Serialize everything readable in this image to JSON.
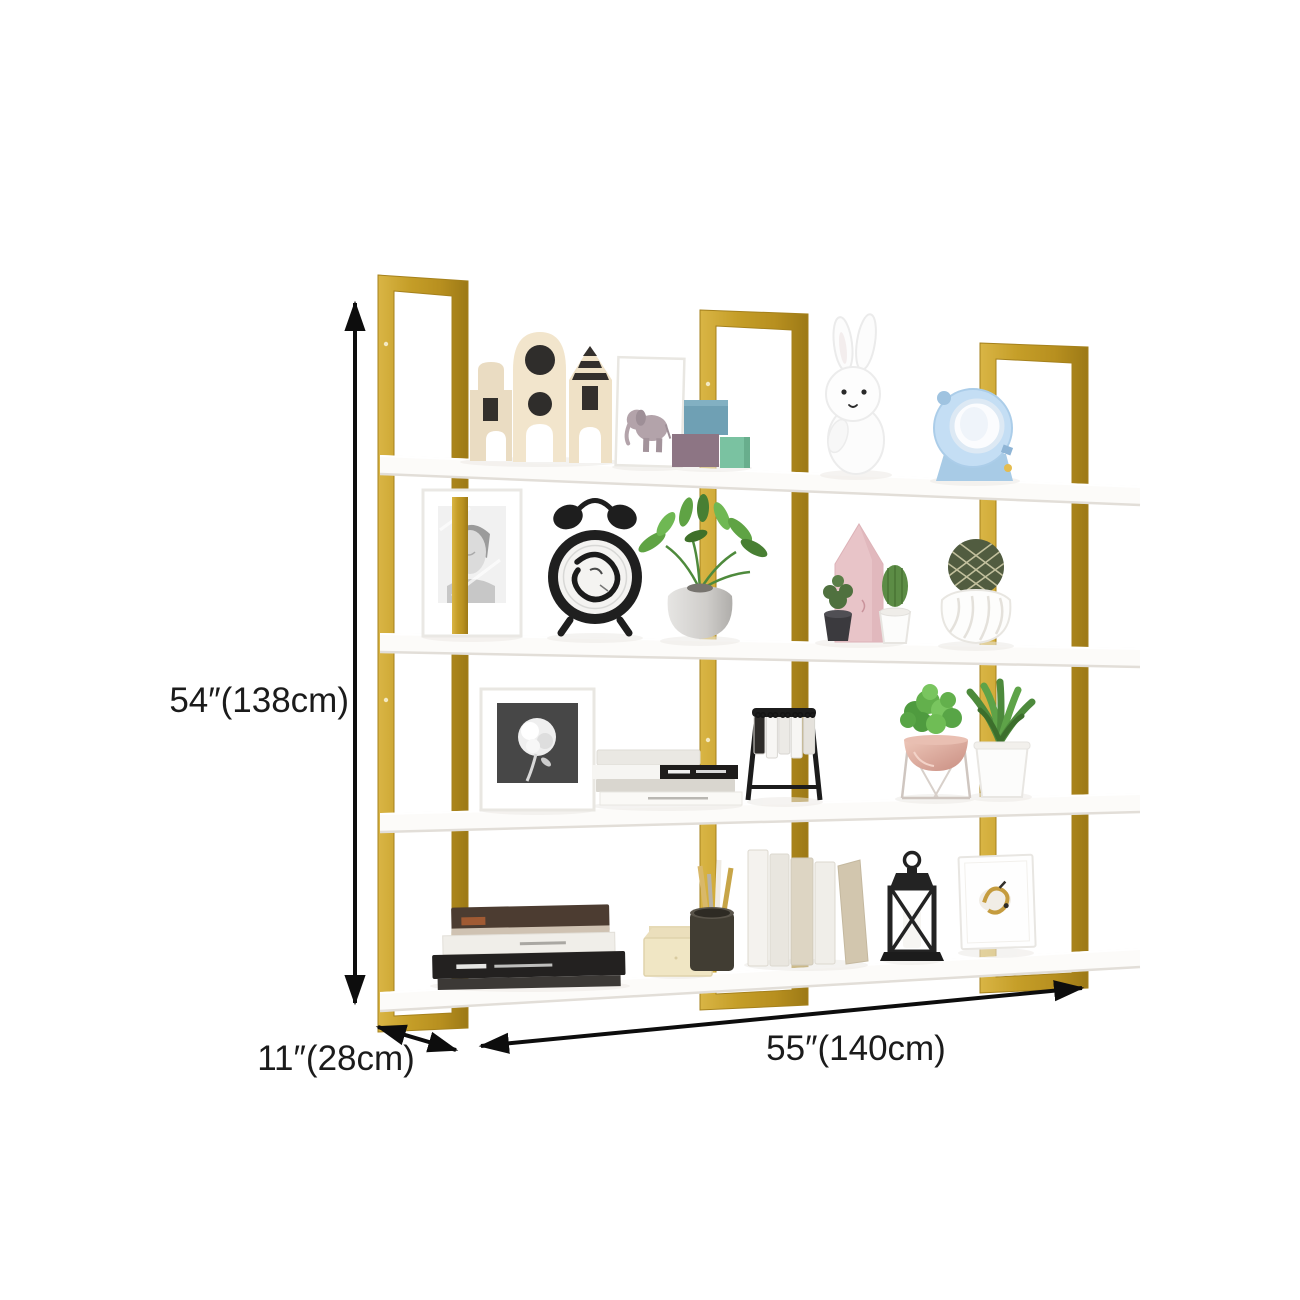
{
  "page": {
    "background": "#ffffff",
    "type": "product-dimension-diagram"
  },
  "product": {
    "frame_color_gold": "#C59E28",
    "frame_gold_light": "#D9B545",
    "frame_gold_dark": "#9C7916",
    "shelf_color": "#FBFAF8",
    "shelf_count": 4,
    "frame_count": 3
  },
  "annotations": {
    "height_label": "54″(138cm)",
    "depth_label": "11″(28cm)",
    "width_label": "55″(140cm)",
    "height_in": "54″",
    "height_cm": "138cm",
    "depth_in": "11″",
    "depth_cm": "28cm",
    "width_in": "55″",
    "width_cm": "140cm",
    "arrow_color": "#0D0D0D",
    "text_color": "#1B1B1B"
  },
  "shelf_items": {
    "shelf_1": [
      "toy-house-blocks",
      "elephant-art-print",
      "stacked-gift-boxes",
      "bunny-figurine",
      "blue-toy-camera"
    ],
    "shelf_2": [
      "portrait-photo-frame",
      "black-alarm-clock",
      "green-plant-in-vase",
      "pink-house-ornament",
      "black-cactus-pot",
      "white-cactus-pot",
      "cactus-ball-in-swirl-vase"
    ],
    "shelf_3": [
      "rose-art-frame",
      "stacked-books",
      "flip-card-calendar",
      "plant-in-copper-bowl-stand",
      "succulent-in-white-pot"
    ],
    "shelf_4": [
      "pile-of-books",
      "cream-letter-holder",
      "pencil-cup",
      "standing-books",
      "black-candle-lantern",
      "canvas-art-print"
    ]
  }
}
